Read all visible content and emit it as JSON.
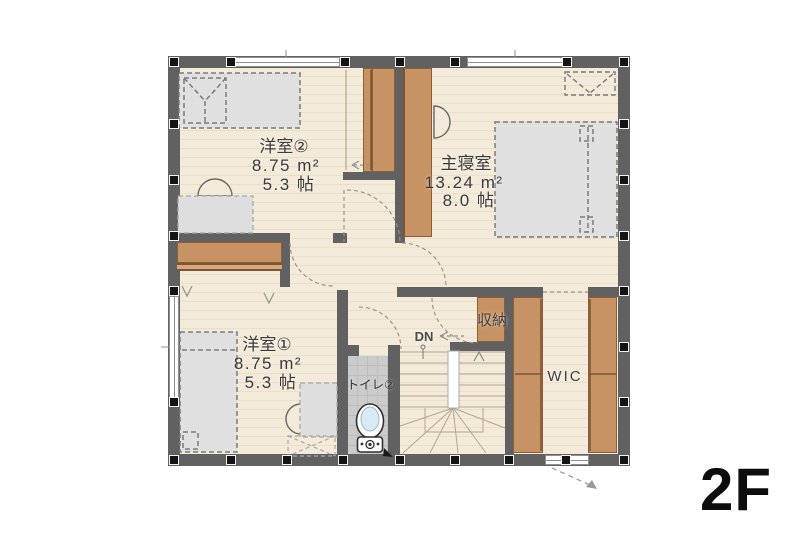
{
  "floor_label": "2F",
  "rooms": {
    "youshitsu2": {
      "name": "洋室②",
      "area": "8.75 m²",
      "tatami": "5.3 帖"
    },
    "master": {
      "name": "主寝室",
      "area": "13.24 m²",
      "tatami": "8.0 帖"
    },
    "youshitsu1": {
      "name": "洋室①",
      "area": "8.75 m²",
      "tatami": "5.3 帖"
    },
    "toilet": {
      "name": "トイレ②"
    },
    "storage": {
      "name": "収納"
    },
    "wic": {
      "name": "WIC"
    },
    "stairs": {
      "label": "DN"
    }
  },
  "colors": {
    "background": "#ffffff",
    "wall": "#616161",
    "floor": "#f4ead9",
    "closet_wood": "#c79364",
    "furniture_gray": "#e0e0e1",
    "toilet_floor": "#cbcbcb"
  }
}
